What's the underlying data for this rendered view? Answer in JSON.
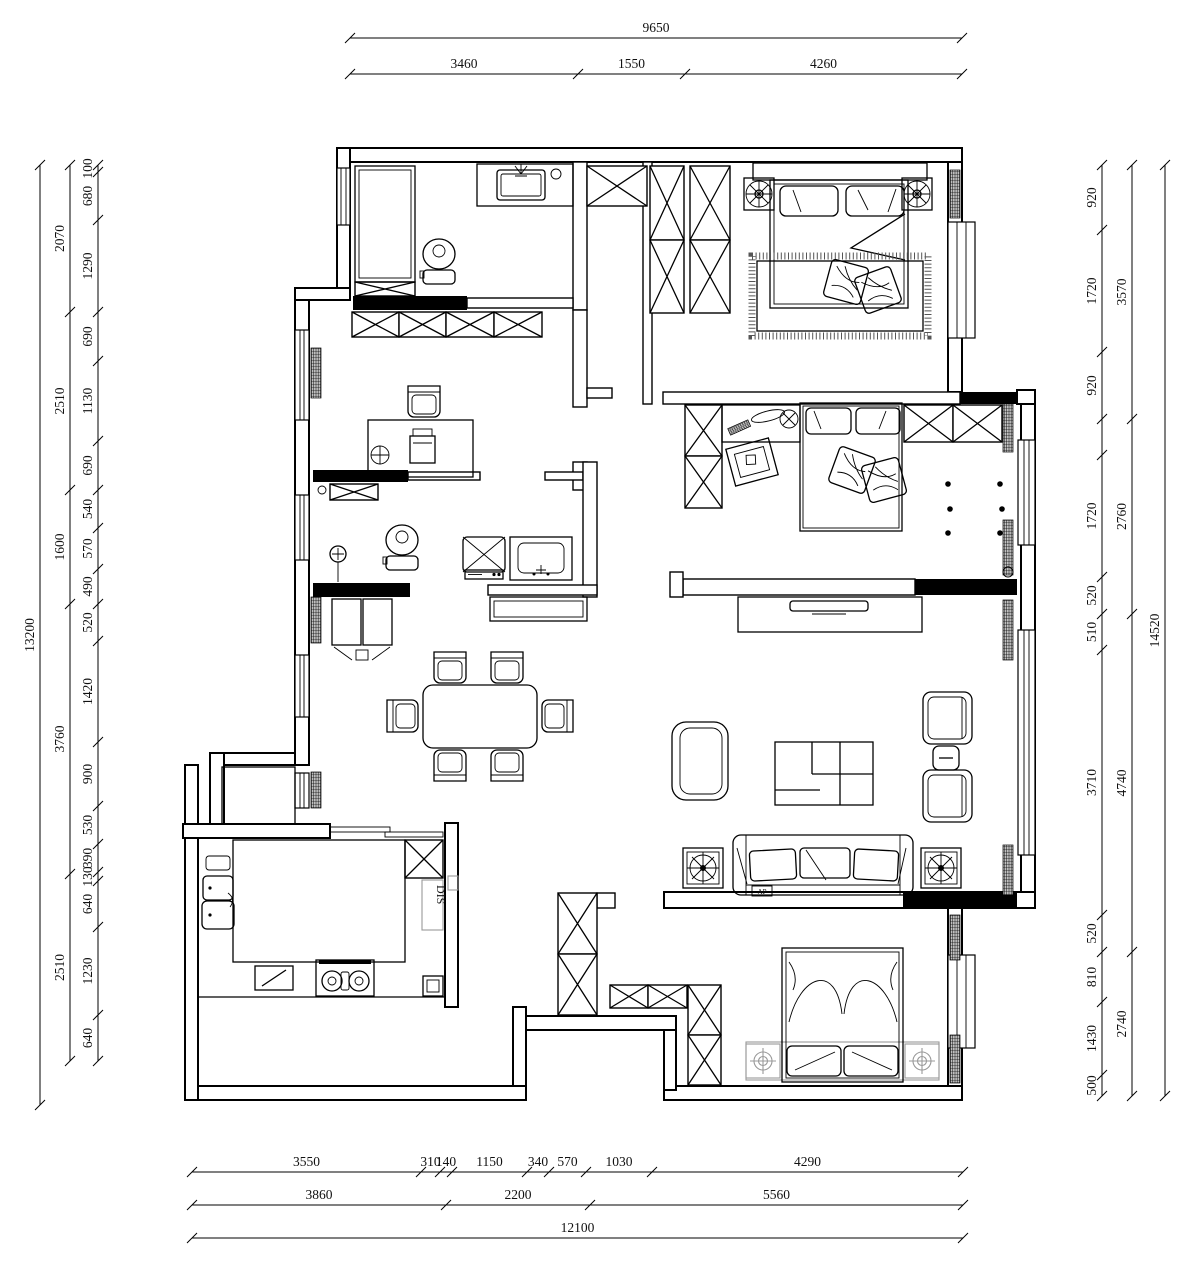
{
  "plan": {
    "type": "apartment-floor-plan",
    "units": "mm",
    "labels": {
      "dishwasher": "DIS",
      "sofa_tag": "AP"
    },
    "colors": {
      "line": "#000000",
      "background": "#ffffff",
      "muted": "#999999"
    }
  },
  "dimensions": {
    "top": {
      "overall": [
        "9650"
      ],
      "segments": [
        "3460",
        "1550",
        "4260"
      ]
    },
    "bottom": {
      "segments": [
        "3550",
        "310",
        "140",
        "1150",
        "340",
        "570",
        "1030",
        "4290"
      ],
      "groups": [
        "3860",
        "2200",
        "5560"
      ],
      "overall": [
        "12100"
      ]
    },
    "left": {
      "outer": [
        "13200"
      ],
      "groups": [
        "2070",
        "2510",
        "1600",
        "3760",
        "2510"
      ],
      "segments": [
        "100",
        "680",
        "1290",
        "690",
        "1130",
        "690",
        "540",
        "570",
        "490",
        "520",
        "1420",
        "900",
        "530",
        "390",
        "130",
        "640",
        "1230",
        "640"
      ]
    },
    "right": {
      "outer": [
        "14520"
      ],
      "groups": [
        "3570",
        "2760",
        "4740",
        "2740"
      ],
      "segments": [
        "920",
        "1720",
        "920",
        "",
        "1720",
        "520",
        "510",
        "3710",
        "520",
        "810",
        "1430",
        "500"
      ]
    }
  }
}
